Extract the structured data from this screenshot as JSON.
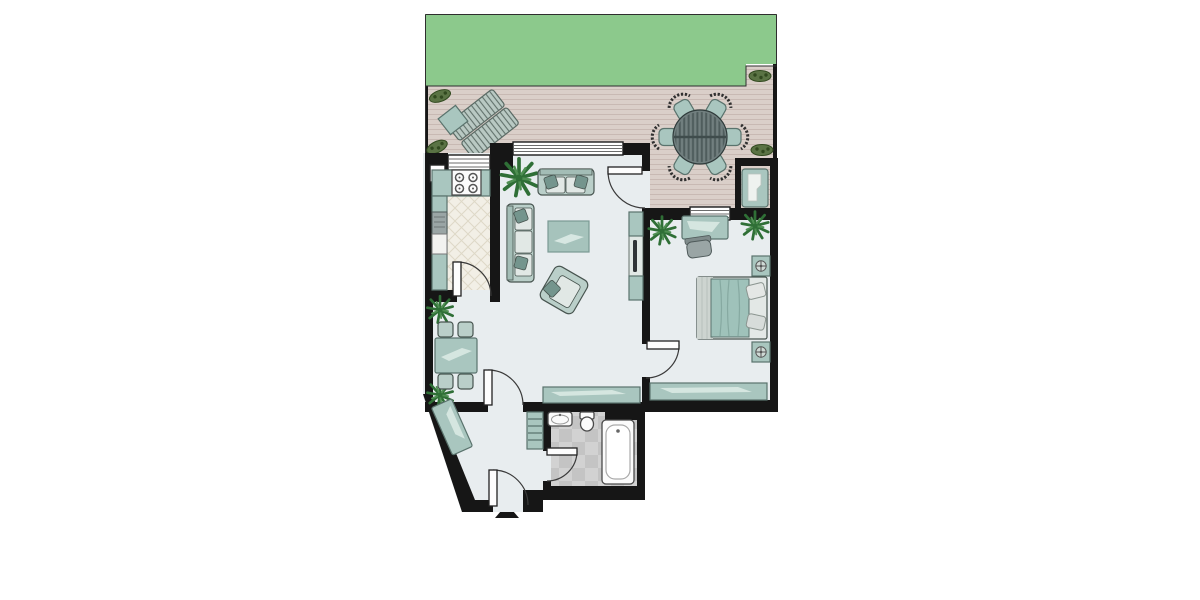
{
  "colors": {
    "page_bg": "#ffffff",
    "lawn": "#8cc98c",
    "deck": "#dacfc9",
    "deck_line": "#c8b9b3",
    "wall": "#161616",
    "floor": "#e8edef",
    "kitchen_floor": "#f2efe6",
    "kitchen_tile_line": "#ded8c7",
    "bath_tile_a": "#d2d2d2",
    "bath_tile_b": "#c4c4c4",
    "teal": "#a9c6bf",
    "teal_light": "#d5e6e0",
    "teal_outline": "#5a736d",
    "sofa": "#bacfc9",
    "sofa_back": "#a3bdb6",
    "cushion": "#e1e8e5",
    "pillow_dark": "#74958d",
    "window_glass": "#ffffff",
    "window_line": "#6b6b6b",
    "door_arc": "#3a3a3a",
    "plant_green": "#2f6f36",
    "plant_light": "#4f8f52",
    "bush_green": "#5a7344",
    "bush_dark": "#31491f",
    "outdoor_table": "#717f7f",
    "outdoor_table_slat": "#4e5c5c",
    "lounger": "#b9c9c3",
    "lounger_slat": "#60706a",
    "gray_item": "#9aa5a5",
    "white_item": "#fbfbfb",
    "mattress": "#e3e8e6",
    "sheet_stripe": "#cdd4d0",
    "blanket": "#9fc2ba",
    "outline_dark": "#47544f"
  },
  "scene": {
    "type": "apartment-floor-plan",
    "outdoor": [
      "lawn",
      "wood-deck-terrace",
      "two-sun-loungers",
      "side-table",
      "round-table-with-six-chairs",
      "sun-lounger-in-niche",
      "shrubs"
    ],
    "rooms": [
      {
        "name": "kitchen",
        "items": [
          "stove-four-burners",
          "counter",
          "oven",
          "appliance",
          "diamond-tile-floor"
        ]
      },
      {
        "name": "living-room",
        "items": [
          "two-seat-sofa",
          "three-seat-sofa",
          "rug",
          "armchair",
          "tv-unit",
          "sideboard",
          "plant"
        ]
      },
      {
        "name": "dining-area",
        "items": [
          "table-for-four",
          "two-plants"
        ]
      },
      {
        "name": "bedroom",
        "items": [
          "double-bed",
          "two-nightstands-with-lamps",
          "desk",
          "desk-chair",
          "sideboard",
          "two-plants"
        ]
      },
      {
        "name": "bathroom",
        "items": [
          "sink",
          "toilet",
          "bathtub",
          "tile-floor"
        ]
      },
      {
        "name": "entry-hall",
        "items": [
          "wardrobe",
          "shelf-unit",
          "entrance-arrow"
        ]
      }
    ],
    "windows": 3,
    "doors": 6,
    "entrance_marker": "triangle-arrow-bottom"
  }
}
